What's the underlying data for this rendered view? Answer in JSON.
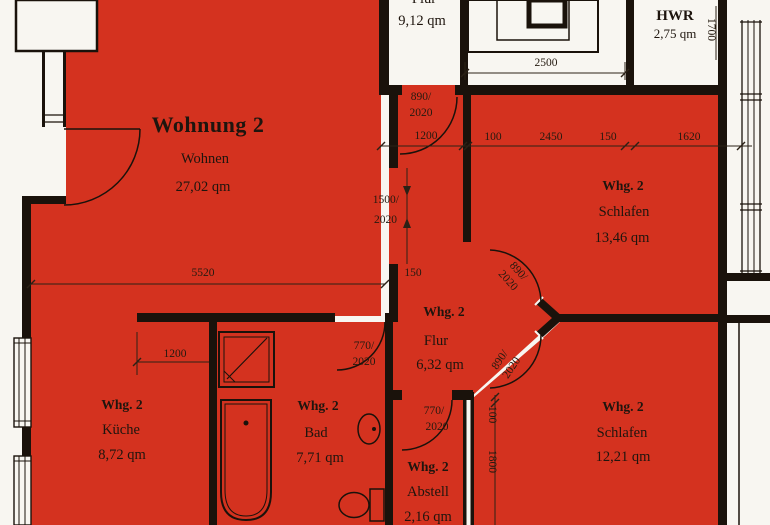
{
  "plan": {
    "type": "floor-plan-scan",
    "highlighted_apartment": "Wohnung 2"
  },
  "rooms": {
    "wohnung2": {
      "title": "Wohnung 2",
      "name": "Wohnen",
      "area": "27,02 qm"
    },
    "schlafen_top": {
      "unit": "Whg. 2",
      "name": "Schlafen",
      "area": "13,46 qm"
    },
    "flur": {
      "unit": "Whg. 2",
      "name": "Flur",
      "area": "6,32 qm"
    },
    "kueche": {
      "unit": "Whg. 2",
      "name": "Küche",
      "area": "8,72 qm"
    },
    "bad": {
      "unit": "Whg. 2",
      "name": "Bad",
      "area": "7,71 qm"
    },
    "abstell": {
      "unit": "Whg. 2",
      "name": "Abstell",
      "area": "2,16 qm"
    },
    "schlafen_bottom": {
      "unit": "Whg. 2",
      "name": "Schlafen",
      "area": "12,21 qm"
    },
    "hwr": {
      "name": "HWR",
      "area": "2,75 qm"
    },
    "stair_hall": {
      "name": "Flur",
      "area": "9,12 qm"
    }
  },
  "dimensions": {
    "stair_bay_width": "2500",
    "hwr_depth": "1700",
    "entry_door_w": "890/",
    "entry_door_h": "2020",
    "entry_opening": "1200",
    "top_d100": "100",
    "top_d2450": "2450",
    "top_d150": "150",
    "top_d1620": "1620",
    "passage_w": "1500/",
    "passage_h": "2020",
    "wall_150": "150",
    "wohnen_width": "5520",
    "kueche_1200": "1200",
    "bad_door_w": "770/",
    "bad_door_h": "2020",
    "schlafen_top_door_w": "890/",
    "schlafen_top_door_h": "2020",
    "schlafen_bottom_door_w": "890/",
    "schlafen_bottom_door_h": "2020",
    "abstell_door_w": "770/",
    "abstell_door_h": "2020",
    "right_v100": "100",
    "right_v1800": "1800"
  },
  "colors": {
    "apartment_highlight": "#d4321f",
    "wall": "#1a120b",
    "paper": "#f7f5f0"
  }
}
